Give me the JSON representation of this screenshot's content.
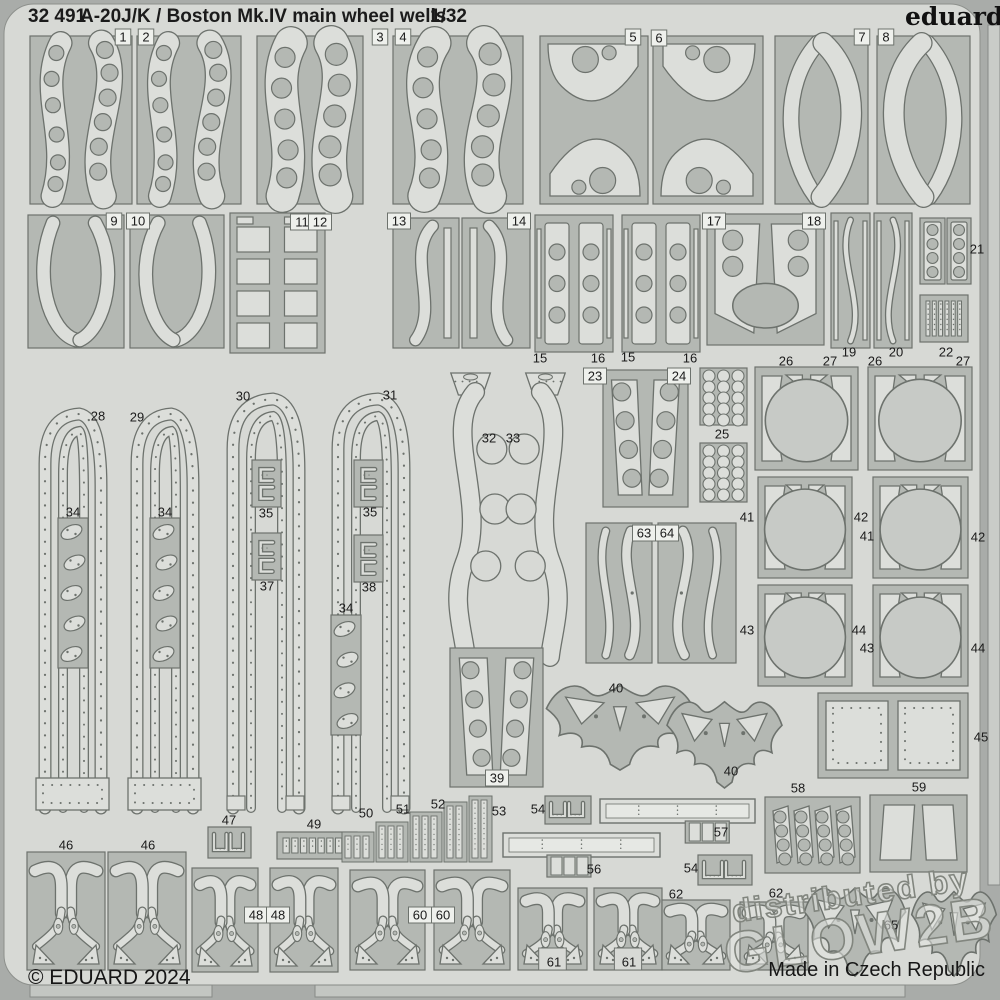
{
  "header": {
    "catalog": "32 491",
    "title": "A-20J/K / Boston Mk.IV main wheel wells",
    "scale": "1/32",
    "brand": "eduard"
  },
  "footer": {
    "copyright": "© EDUARD 2024",
    "origin": "Made in Czech Republic"
  },
  "watermark": {
    "line1": "distributed by",
    "line2": "GLOW2B"
  },
  "colors": {
    "bg": "#a9aca9",
    "sheet": "#d7d9d5",
    "panel": "#b4b8b3",
    "part": "#dcdeda",
    "outline": "#6d726d",
    "disc": "#c7cac6",
    "edge": "#8d908c",
    "label_text": "#1b1b1b",
    "label_box": "#eef0ec",
    "wm_fill": "rgba(228,230,226,0.55)",
    "wm_stroke": "#82867f"
  },
  "panels": [
    {
      "id": "1",
      "x": 30,
      "y": 36,
      "w": 102,
      "h": 168,
      "kind": "blades"
    },
    {
      "id": "2",
      "x": 137,
      "y": 36,
      "w": 104,
      "h": 168,
      "kind": "blades"
    },
    {
      "id": "3",
      "x": 257,
      "y": 36,
      "w": 106,
      "h": 168,
      "kind": "blades2"
    },
    {
      "id": "4",
      "x": 393,
      "y": 36,
      "w": 130,
      "h": 168,
      "kind": "blades2"
    },
    {
      "id": "5",
      "x": 540,
      "y": 36,
      "w": 108,
      "h": 168,
      "kind": "sblob"
    },
    {
      "id": "6",
      "x": 653,
      "y": 36,
      "w": 110,
      "h": 168,
      "kind": "sblob",
      "flip": true
    },
    {
      "id": "7",
      "x": 775,
      "y": 36,
      "w": 93,
      "h": 168,
      "kind": "leaf"
    },
    {
      "id": "8",
      "x": 877,
      "y": 36,
      "w": 93,
      "h": 168,
      "kind": "leaf",
      "flip": true
    },
    {
      "id": "9",
      "x": 28,
      "y": 215,
      "w": 96,
      "h": 133,
      "kind": "leafdown"
    },
    {
      "id": "10",
      "x": 130,
      "y": 215,
      "w": 94,
      "h": 133,
      "kind": "leafdown",
      "flip": true
    },
    {
      "id": "11-12",
      "x": 230,
      "y": 213,
      "w": 95,
      "h": 140,
      "kind": "stack"
    },
    {
      "id": "13",
      "x": 393,
      "y": 218,
      "w": 66,
      "h": 130,
      "kind": "blade1"
    },
    {
      "id": "14",
      "x": 462,
      "y": 218,
      "w": 68,
      "h": 130,
      "kind": "blade1",
      "flip": true
    },
    {
      "id": "15-16a",
      "x": 535,
      "y": 215,
      "w": 78,
      "h": 137,
      "kind": "strip3"
    },
    {
      "id": "15-16b",
      "x": 622,
      "y": 215,
      "w": 78,
      "h": 137,
      "kind": "strip3"
    },
    {
      "id": "17-18",
      "x": 707,
      "y": 214,
      "w": 117,
      "h": 131,
      "kind": "trapoval"
    },
    {
      "id": "19",
      "x": 831,
      "y": 213,
      "w": 39,
      "h": 135,
      "kind": "sthin"
    },
    {
      "id": "20",
      "x": 874,
      "y": 213,
      "w": 38,
      "h": 135,
      "kind": "sthin",
      "flip": true
    },
    {
      "id": "21a",
      "x": 920,
      "y": 218,
      "w": 25,
      "h": 66,
      "kind": "rect4"
    },
    {
      "id": "21b",
      "x": 947,
      "y": 218,
      "w": 24,
      "h": 66,
      "kind": "rect4"
    },
    {
      "id": "22",
      "x": 920,
      "y": 295,
      "w": 48,
      "h": 47,
      "kind": "vstrips",
      "n": 6
    },
    {
      "id": "28",
      "x": 30,
      "y": 400,
      "w": 85,
      "h": 412,
      "kind": "arch",
      "plate": true
    },
    {
      "id": "29",
      "x": 122,
      "y": 400,
      "w": 85,
      "h": 412,
      "kind": "arch",
      "plate": true
    },
    {
      "id": "30",
      "x": 218,
      "y": 385,
      "w": 95,
      "h": 427,
      "kind": "arch"
    },
    {
      "id": "31",
      "x": 323,
      "y": 385,
      "w": 95,
      "h": 427,
      "kind": "arch"
    },
    {
      "id": "34a",
      "x": 58,
      "y": 518,
      "w": 30,
      "h": 150,
      "kind": "ovals",
      "n": 5
    },
    {
      "id": "34b",
      "x": 150,
      "y": 518,
      "w": 30,
      "h": 150,
      "kind": "ovals",
      "n": 5
    },
    {
      "id": "34c",
      "x": 331,
      "y": 615,
      "w": 30,
      "h": 120,
      "kind": "ovals",
      "n": 4
    },
    {
      "id": "35a",
      "x": 252,
      "y": 460,
      "w": 29,
      "h": 47,
      "kind": "brackets"
    },
    {
      "id": "37",
      "x": 252,
      "y": 533,
      "w": 29,
      "h": 47,
      "kind": "brackets"
    },
    {
      "id": "35b",
      "x": 354,
      "y": 460,
      "w": 29,
      "h": 47,
      "kind": "brackets"
    },
    {
      "id": "38",
      "x": 354,
      "y": 535,
      "w": 29,
      "h": 47,
      "kind": "brackets"
    },
    {
      "id": "32",
      "x": 428,
      "y": 365,
      "w": 76,
      "h": 300,
      "kind": "swave"
    },
    {
      "id": "33",
      "x": 512,
      "y": 365,
      "w": 76,
      "h": 300,
      "kind": "swave",
      "flip": true
    },
    {
      "id": "23-24",
      "x": 603,
      "y": 370,
      "w": 85,
      "h": 137,
      "kind": "trap4"
    },
    {
      "id": "25a",
      "x": 700,
      "y": 368,
      "w": 47,
      "h": 57,
      "kind": "cgrid"
    },
    {
      "id": "25b",
      "x": 700,
      "y": 443,
      "w": 47,
      "h": 59,
      "kind": "cgrid"
    },
    {
      "id": "63",
      "x": 586,
      "y": 523,
      "w": 66,
      "h": 140,
      "kind": "wavy2"
    },
    {
      "id": "64",
      "x": 658,
      "y": 523,
      "w": 78,
      "h": 140,
      "kind": "wavy2",
      "flip": true
    },
    {
      "id": "26-27a",
      "x": 755,
      "y": 367,
      "w": 103,
      "h": 103,
      "kind": "disc"
    },
    {
      "id": "26-27b",
      "x": 868,
      "y": 367,
      "w": 104,
      "h": 103,
      "kind": "disc"
    },
    {
      "id": "41-42a",
      "x": 758,
      "y": 477,
      "w": 94,
      "h": 101,
      "kind": "disc"
    },
    {
      "id": "41-42b",
      "x": 873,
      "y": 477,
      "w": 95,
      "h": 101,
      "kind": "disc"
    },
    {
      "id": "43-44a",
      "x": 758,
      "y": 585,
      "w": 94,
      "h": 101,
      "kind": "disc"
    },
    {
      "id": "43-44b",
      "x": 873,
      "y": 585,
      "w": 95,
      "h": 101,
      "kind": "disc"
    },
    {
      "id": "39",
      "x": 450,
      "y": 648,
      "w": 93,
      "h": 139,
      "kind": "trap4b"
    },
    {
      "id": "40a",
      "x": 540,
      "y": 676,
      "w": 160,
      "h": 96,
      "kind": "bat"
    },
    {
      "id": "40b",
      "x": 662,
      "y": 692,
      "w": 125,
      "h": 98,
      "kind": "bat",
      "flip": true
    },
    {
      "id": "45",
      "x": 818,
      "y": 693,
      "w": 150,
      "h": 85,
      "kind": "plates"
    },
    {
      "id": "46a",
      "x": 27,
      "y": 852,
      "w": 78,
      "h": 118,
      "kind": "wishbone"
    },
    {
      "id": "46b",
      "x": 108,
      "y": 852,
      "w": 78,
      "h": 118,
      "kind": "wishbone"
    },
    {
      "id": "47",
      "x": 208,
      "y": 827,
      "w": 43,
      "h": 31,
      "kind": "brackets2"
    },
    {
      "id": "49",
      "x": 277,
      "y": 832,
      "w": 80,
      "h": 27,
      "kind": "vstrips",
      "n": 8
    },
    {
      "id": "48a",
      "x": 192,
      "y": 868,
      "w": 66,
      "h": 104,
      "kind": "wishbone"
    },
    {
      "id": "48b",
      "x": 270,
      "y": 868,
      "w": 68,
      "h": 104,
      "kind": "wishbone"
    },
    {
      "id": "50-53",
      "x": 340,
      "y": 795,
      "w": 153,
      "h": 67,
      "kind": "stairs"
    },
    {
      "id": "54a",
      "x": 545,
      "y": 796,
      "w": 46,
      "h": 28,
      "kind": "brackets2"
    },
    {
      "id": "57",
      "x": 600,
      "y": 799,
      "w": 155,
      "h": 44,
      "kind": "bar",
      "notch": "right"
    },
    {
      "id": "56",
      "x": 503,
      "y": 833,
      "w": 157,
      "h": 44,
      "kind": "bar",
      "notch": "left"
    },
    {
      "id": "54b",
      "x": 698,
      "y": 855,
      "w": 54,
      "h": 30,
      "kind": "brackets2"
    },
    {
      "id": "58",
      "x": 765,
      "y": 797,
      "w": 95,
      "h": 76,
      "kind": "slants"
    },
    {
      "id": "59",
      "x": 870,
      "y": 795,
      "w": 97,
      "h": 77,
      "kind": "trap2"
    },
    {
      "id": "60a",
      "x": 350,
      "y": 870,
      "w": 75,
      "h": 100,
      "kind": "wishbone"
    },
    {
      "id": "60b",
      "x": 434,
      "y": 870,
      "w": 76,
      "h": 100,
      "kind": "wishbone"
    },
    {
      "id": "61a",
      "x": 518,
      "y": 888,
      "w": 69,
      "h": 82,
      "kind": "wishbone",
      "notch": true
    },
    {
      "id": "61b",
      "x": 594,
      "y": 888,
      "w": 68,
      "h": 82,
      "kind": "wishbone",
      "notch": true
    },
    {
      "id": "62a",
      "x": 662,
      "y": 900,
      "w": 68,
      "h": 70,
      "kind": "wishbone"
    },
    {
      "id": "62b",
      "x": 740,
      "y": 902,
      "w": 68,
      "h": 68,
      "kind": "wishbone"
    },
    {
      "id": "65a",
      "x": 800,
      "y": 878,
      "w": 110,
      "h": 100,
      "kind": "bat"
    },
    {
      "id": "65b",
      "x": 908,
      "y": 882,
      "w": 92,
      "h": 96,
      "kind": "bat",
      "flip": true
    }
  ],
  "labels": [
    {
      "t": "1",
      "x": 123,
      "y": 37,
      "b": true
    },
    {
      "t": "2",
      "x": 146,
      "y": 37,
      "b": true
    },
    {
      "t": "3",
      "x": 380,
      "y": 37,
      "b": true
    },
    {
      "t": "4",
      "x": 403,
      "y": 37,
      "b": true
    },
    {
      "t": "5",
      "x": 633,
      "y": 37,
      "b": true
    },
    {
      "t": "6",
      "x": 659,
      "y": 38,
      "b": true
    },
    {
      "t": "7",
      "x": 862,
      "y": 37,
      "b": true
    },
    {
      "t": "8",
      "x": 886,
      "y": 37,
      "b": true
    },
    {
      "t": "9",
      "x": 114,
      "y": 221,
      "b": true
    },
    {
      "t": "10",
      "x": 138,
      "y": 221,
      "b": true
    },
    {
      "t": "11",
      "x": 302,
      "y": 222,
      "b": true
    },
    {
      "t": "12",
      "x": 320,
      "y": 222,
      "b": true
    },
    {
      "t": "13",
      "x": 399,
      "y": 221,
      "b": true
    },
    {
      "t": "14",
      "x": 519,
      "y": 221,
      "b": true
    },
    {
      "t": "17",
      "x": 714,
      "y": 221,
      "b": true
    },
    {
      "t": "18",
      "x": 814,
      "y": 221,
      "b": true
    },
    {
      "t": "21",
      "x": 977,
      "y": 249
    },
    {
      "t": "15",
      "x": 540,
      "y": 358
    },
    {
      "t": "16",
      "x": 598,
      "y": 358
    },
    {
      "t": "15",
      "x": 628,
      "y": 357
    },
    {
      "t": "16",
      "x": 690,
      "y": 358
    },
    {
      "t": "19",
      "x": 849,
      "y": 352
    },
    {
      "t": "20",
      "x": 896,
      "y": 352
    },
    {
      "t": "22",
      "x": 946,
      "y": 352
    },
    {
      "t": "26",
      "x": 786,
      "y": 361
    },
    {
      "t": "27",
      "x": 830,
      "y": 361
    },
    {
      "t": "26",
      "x": 875,
      "y": 361
    },
    {
      "t": "27",
      "x": 963,
      "y": 361
    },
    {
      "t": "28",
      "x": 98,
      "y": 416
    },
    {
      "t": "29",
      "x": 137,
      "y": 417
    },
    {
      "t": "30",
      "x": 243,
      "y": 396
    },
    {
      "t": "31",
      "x": 390,
      "y": 395
    },
    {
      "t": "32",
      "x": 489,
      "y": 438
    },
    {
      "t": "33",
      "x": 513,
      "y": 438
    },
    {
      "t": "23",
      "x": 595,
      "y": 376,
      "b": true
    },
    {
      "t": "24",
      "x": 679,
      "y": 376,
      "b": true
    },
    {
      "t": "25",
      "x": 722,
      "y": 434
    },
    {
      "t": "34",
      "x": 73,
      "y": 512
    },
    {
      "t": "34",
      "x": 165,
      "y": 512
    },
    {
      "t": "35",
      "x": 266,
      "y": 513
    },
    {
      "t": "35",
      "x": 370,
      "y": 512
    },
    {
      "t": "37",
      "x": 267,
      "y": 586
    },
    {
      "t": "38",
      "x": 369,
      "y": 587
    },
    {
      "t": "34",
      "x": 346,
      "y": 608
    },
    {
      "t": "63",
      "x": 644,
      "y": 533,
      "b": true
    },
    {
      "t": "64",
      "x": 667,
      "y": 533,
      "b": true
    },
    {
      "t": "41",
      "x": 747,
      "y": 517
    },
    {
      "t": "42",
      "x": 861,
      "y": 517
    },
    {
      "t": "41",
      "x": 867,
      "y": 536
    },
    {
      "t": "42",
      "x": 978,
      "y": 537
    },
    {
      "t": "43",
      "x": 747,
      "y": 630
    },
    {
      "t": "44",
      "x": 859,
      "y": 630
    },
    {
      "t": "43",
      "x": 867,
      "y": 648
    },
    {
      "t": "44",
      "x": 978,
      "y": 648
    },
    {
      "t": "39",
      "x": 497,
      "y": 778,
      "b": true
    },
    {
      "t": "40",
      "x": 616,
      "y": 688
    },
    {
      "t": "40",
      "x": 731,
      "y": 771
    },
    {
      "t": "45",
      "x": 981,
      "y": 737
    },
    {
      "t": "46",
      "x": 66,
      "y": 845
    },
    {
      "t": "46",
      "x": 148,
      "y": 845
    },
    {
      "t": "47",
      "x": 229,
      "y": 820
    },
    {
      "t": "49",
      "x": 314,
      "y": 824
    },
    {
      "t": "48",
      "x": 256,
      "y": 915,
      "b": true
    },
    {
      "t": "48",
      "x": 278,
      "y": 915,
      "b": true
    },
    {
      "t": "50",
      "x": 366,
      "y": 813
    },
    {
      "t": "51",
      "x": 403,
      "y": 809
    },
    {
      "t": "52",
      "x": 438,
      "y": 804
    },
    {
      "t": "53",
      "x": 499,
      "y": 811
    },
    {
      "t": "54",
      "x": 538,
      "y": 809
    },
    {
      "t": "57",
      "x": 721,
      "y": 832
    },
    {
      "t": "56",
      "x": 594,
      "y": 869
    },
    {
      "t": "54",
      "x": 691,
      "y": 868
    },
    {
      "t": "58",
      "x": 798,
      "y": 788
    },
    {
      "t": "59",
      "x": 919,
      "y": 787
    },
    {
      "t": "60",
      "x": 420,
      "y": 915,
      "b": true
    },
    {
      "t": "60",
      "x": 443,
      "y": 915,
      "b": true
    },
    {
      "t": "61",
      "x": 554,
      "y": 962
    },
    {
      "t": "61",
      "x": 629,
      "y": 962
    },
    {
      "t": "62",
      "x": 676,
      "y": 894
    },
    {
      "t": "62",
      "x": 776,
      "y": 893
    },
    {
      "t": "65",
      "x": 891,
      "y": 925
    }
  ]
}
